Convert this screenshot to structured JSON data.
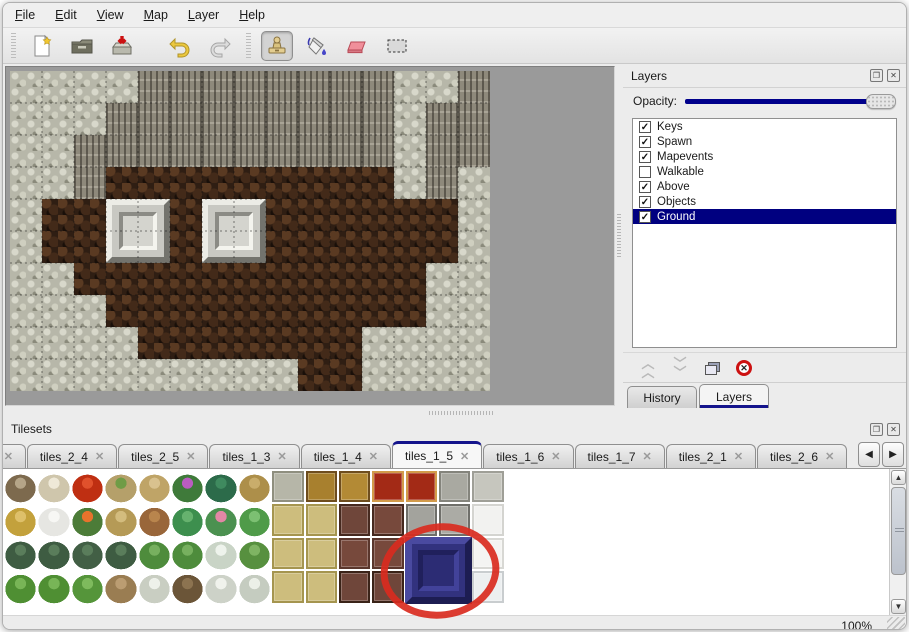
{
  "menu": {
    "items": [
      {
        "label": "File"
      },
      {
        "label": "Edit"
      },
      {
        "label": "View"
      },
      {
        "label": "Map"
      },
      {
        "label": "Layer"
      },
      {
        "label": "Help"
      }
    ]
  },
  "toolbar": {
    "buttons": [
      {
        "name": "new-map-button",
        "icon": "new-file-icon",
        "selected": false
      },
      {
        "name": "open-button",
        "icon": "open-folder-icon",
        "selected": false
      },
      {
        "name": "save-button",
        "icon": "save-icon",
        "selected": false
      },
      {
        "name": "undo-button",
        "icon": "undo-arrow-icon",
        "selected": false
      },
      {
        "name": "redo-button",
        "icon": "redo-arrow-icon",
        "selected": false
      },
      {
        "name": "stamp-tool-button",
        "icon": "stamp-icon",
        "selected": true
      },
      {
        "name": "fill-tool-button",
        "icon": "paint-bucket-icon",
        "selected": false
      },
      {
        "name": "eraser-tool-button",
        "icon": "eraser-icon",
        "selected": false
      },
      {
        "name": "select-tool-button",
        "icon": "selection-rect-icon",
        "selected": false
      }
    ]
  },
  "map": {
    "tile_size": 32,
    "columns": 15,
    "rows": 10,
    "legend": {
      "R": "light-rock",
      "C": "dark-cliff",
      "F": "brown-floor"
    },
    "grid": [
      "RRRRCCCCCCCCRRC",
      "RRRCCCCCCCCCRCC",
      "RRCCCCCCCCCCRCC",
      "RRCFFFFFFFFFRCR",
      "RFFFFFFFFFFFFFR",
      "RFFFFFFFFFFFFFR",
      "RRFFFFFFFFFFFRR",
      "RRRFFFFFFFFFFRR",
      "RRRRFFFFFFFRRRR",
      "RRRRRRRRRFFRRRR"
    ],
    "blocks": [
      {
        "col": 3,
        "row": 4,
        "size": 2
      },
      {
        "col": 6,
        "row": 4,
        "size": 2
      }
    ],
    "colors": {
      "rock": "#b7b7a9",
      "cliff": "#8e897b",
      "floor": "#2f1e13",
      "grid_line": "rgba(15,15,15,0.5)"
    }
  },
  "layers_panel": {
    "title": "Layers",
    "titlebar_icons": [
      "float-icon",
      "close-icon"
    ],
    "opacity_label": "Opacity:",
    "slider_color": "#00008b",
    "selection_color": "#000080",
    "layers": [
      {
        "label": "Keys",
        "checked": true,
        "selected": false
      },
      {
        "label": "Spawn",
        "checked": true,
        "selected": false
      },
      {
        "label": "Mapevents",
        "checked": true,
        "selected": false
      },
      {
        "label": "Walkable",
        "checked": false,
        "selected": false
      },
      {
        "label": "Above",
        "checked": true,
        "selected": false
      },
      {
        "label": "Objects",
        "checked": true,
        "selected": false
      },
      {
        "label": "Ground",
        "checked": true,
        "selected": true
      }
    ],
    "action_buttons": [
      {
        "name": "layer-up-button",
        "icon": "chevron-double-up-icon",
        "enabled": false
      },
      {
        "name": "layer-down-button",
        "icon": "chevron-double-down-icon",
        "enabled": false
      },
      {
        "name": "layer-duplicate-button",
        "icon": "duplicate-icon",
        "enabled": true
      },
      {
        "name": "layer-delete-button",
        "icon": "delete-circle-icon",
        "enabled": true
      }
    ],
    "tabs": [
      {
        "label": "History",
        "active": false
      },
      {
        "label": "Layers",
        "active": true
      }
    ]
  },
  "tilesets_panel": {
    "title": "Tilesets",
    "titlebar_icons": [
      "float-icon",
      "close-icon"
    ],
    "close_glyph": "✕",
    "tabs": [
      {
        "label": "3",
        "active": false,
        "clipped": true
      },
      {
        "label": "tiles_2_4",
        "active": false
      },
      {
        "label": "tiles_2_5",
        "active": false
      },
      {
        "label": "tiles_1_3",
        "active": false
      },
      {
        "label": "tiles_1_4",
        "active": false
      },
      {
        "label": "tiles_1_5",
        "active": true
      },
      {
        "label": "tiles_1_6",
        "active": false
      },
      {
        "label": "tiles_1_7",
        "active": false
      },
      {
        "label": "tiles_2_1",
        "active": false
      },
      {
        "label": "tiles_2_6",
        "active": false
      }
    ],
    "tab_scroll_icons": [
      "scroll-left-icon",
      "scroll-right-icon"
    ],
    "scroll_glyphs": {
      "left": "◀",
      "right": "▶",
      "up": "▲",
      "down": "▼"
    },
    "palette": {
      "columns": 21,
      "cell_size": 33.4,
      "rows": [
        [
          [
            "dead-tree",
            "b",
            "#7d6a4e",
            "#b5a588"
          ],
          [
            "branch-tree",
            "b",
            "#cfc6ac",
            "#efe9d8"
          ],
          [
            "rafflesia-flower",
            "b",
            "#bf2f12",
            "#e0512c"
          ],
          [
            "grass-stump",
            "b",
            "#b5a06a",
            "#6f9c46"
          ],
          [
            "termite-mound",
            "b",
            "#bfa467",
            "#d9c28f"
          ],
          [
            "purple-flower-bush",
            "b",
            "#3f7a3a",
            "#bb5cc0"
          ],
          [
            "dark-palm-plant",
            "b",
            "#2c6b4a",
            "#3f8a5f"
          ],
          [
            "dry-plant",
            "b",
            "#ad8f4a",
            "#c9ad6b"
          ],
          [
            "stone-floor-tile",
            "f",
            "#b6b6a8",
            "#8f8f7f"
          ],
          [
            "gold-table",
            "f",
            "#a8802e",
            "#6e4d1e"
          ],
          [
            "gold-table",
            "f",
            "#b38a35",
            "#6e4d1e"
          ],
          [
            "red-carpet",
            "f",
            "#a32a16",
            "#d29b4a"
          ],
          [
            "red-carpet",
            "f",
            "#a32a16",
            "#d29b4a"
          ],
          [
            "gray-stone-tile",
            "f",
            "#a9a9a1",
            "#84847c"
          ],
          [
            "gray-stone-tile",
            "f",
            "#c6c6be",
            "#9f9f97"
          ]
        ],
        [
          [
            "straw-mound",
            "b",
            "#c3a13c",
            "#dec06a"
          ],
          [
            "snow-mound",
            "b",
            "#e6e6e2",
            "#f7f7f4"
          ],
          [
            "flower-bush",
            "b",
            "#4c7c38",
            "#e8732c"
          ],
          [
            "grass-tuft",
            "b",
            "#b59a56",
            "#d3bc7e"
          ],
          [
            "fallen-leaves",
            "b",
            "#99663a",
            "#b9854d"
          ],
          [
            "lily-pad",
            "b",
            "#3d8f4e",
            "#66b26e"
          ],
          [
            "pink-flower-lily",
            "b",
            "#4b9150",
            "#e287a5"
          ],
          [
            "lily-pad",
            "b",
            "#4f9b49",
            "#7cc072"
          ],
          [
            "khaki-floor",
            "f",
            "#cdbd7d",
            "#a5954f"
          ],
          [
            "khaki-floor",
            "f",
            "#cdbd7d",
            "#a5954f"
          ],
          [
            "brown-table",
            "f",
            "#6f463a",
            "#46291f"
          ],
          [
            "brown-table",
            "f",
            "#77493c",
            "#46291f"
          ],
          [
            "stone-arch",
            "f",
            "#a3a39d",
            "#6f6f6a"
          ],
          [
            "stone-arch",
            "f",
            "#ababa5",
            "#6f6f6a"
          ],
          [
            "white-fluffy-tile",
            "f",
            "#f2f2f0",
            "#d4d4d0"
          ]
        ],
        [
          [
            "small-bushes",
            "b",
            "#3e5c42",
            "#5a7d5b"
          ],
          [
            "small-bushes",
            "b",
            "#3e5c42",
            "#5a7d5b"
          ],
          [
            "small-bushes",
            "b",
            "#425f45",
            "#5a7d5b"
          ],
          [
            "small-bushes",
            "b",
            "#3e5c42",
            "#5a7d5b"
          ],
          [
            "palm-tree",
            "b",
            "#4e8c3c",
            "#77b05f"
          ],
          [
            "palm-tree",
            "b",
            "#4e8c3c",
            "#77b05f"
          ],
          [
            "snowy-palm-tree",
            "b",
            "#c9d4c6",
            "#eef3ec"
          ],
          [
            "palm-tree",
            "b",
            "#57903f",
            "#7fb463"
          ],
          [
            "khaki-floor",
            "f",
            "#cdbd7d",
            "#a5954f"
          ],
          [
            "khaki-floor",
            "f",
            "#cdbd7d",
            "#a5954f"
          ],
          [
            "brown-tile",
            "f",
            "#77493c",
            "#5a362c"
          ],
          [
            "brown-tile",
            "f",
            "#77493c",
            "#5a362c"
          ],
          [
            "blue-table-tile",
            "f",
            "#32327e",
            "#23235c"
          ],
          [
            "blue-table-tile",
            "f",
            "#32327e",
            "#23235c"
          ],
          [
            "white-fluffy-tile",
            "f",
            "#f4f4f2",
            "#d8d8d4"
          ]
        ],
        [
          [
            "conifer-bush",
            "b",
            "#4f8f33",
            "#78b557"
          ],
          [
            "conifer-bush",
            "b",
            "#4f8f33",
            "#78b557"
          ],
          [
            "conifer-bush",
            "b",
            "#55953a",
            "#7eba5d"
          ],
          [
            "dead-trunk-tree",
            "b",
            "#9a7d52",
            "#bb9d72"
          ],
          [
            "snowy-tree",
            "b",
            "#c9cec2",
            "#eef1ea"
          ],
          [
            "dark-trunk-tree",
            "b",
            "#6b5538",
            "#8c7350"
          ],
          [
            "snowy-tree",
            "b",
            "#cdd2c8",
            "#f0f2ec"
          ],
          [
            "snowy-tree",
            "b",
            "#c5ccc0",
            "#ecf0e8"
          ],
          [
            "khaki-floor",
            "f",
            "#cdbd7d",
            "#a5954f"
          ],
          [
            "khaki-floor",
            "f",
            "#cdbd7d",
            "#a5954f"
          ],
          [
            "brown-table-legs",
            "f",
            "#6f463a",
            "#3a2318"
          ],
          [
            "brown-table-legs",
            "f",
            "#6f463a",
            "#3a2318"
          ],
          [
            "blue-table-tile",
            "f",
            "#32327e",
            "#23235c"
          ],
          [
            "blue-table-tile",
            "f",
            "#32327e",
            "#23235c"
          ],
          [
            "white-fluffy-tile",
            "f",
            "#eceff0",
            "#c9cdcf"
          ]
        ]
      ]
    },
    "highlight_block": {
      "col": 12,
      "row": 2,
      "span": 2,
      "color": "#32327e",
      "label": "blue-table-tile"
    },
    "annotation": {
      "shape": "red-circle",
      "color": "#d92b20"
    }
  },
  "statusbar": {
    "zoom": "100%"
  },
  "glyphs": {
    "check": "✓",
    "close": "✕",
    "float": "❐",
    "x_button": "✕"
  }
}
